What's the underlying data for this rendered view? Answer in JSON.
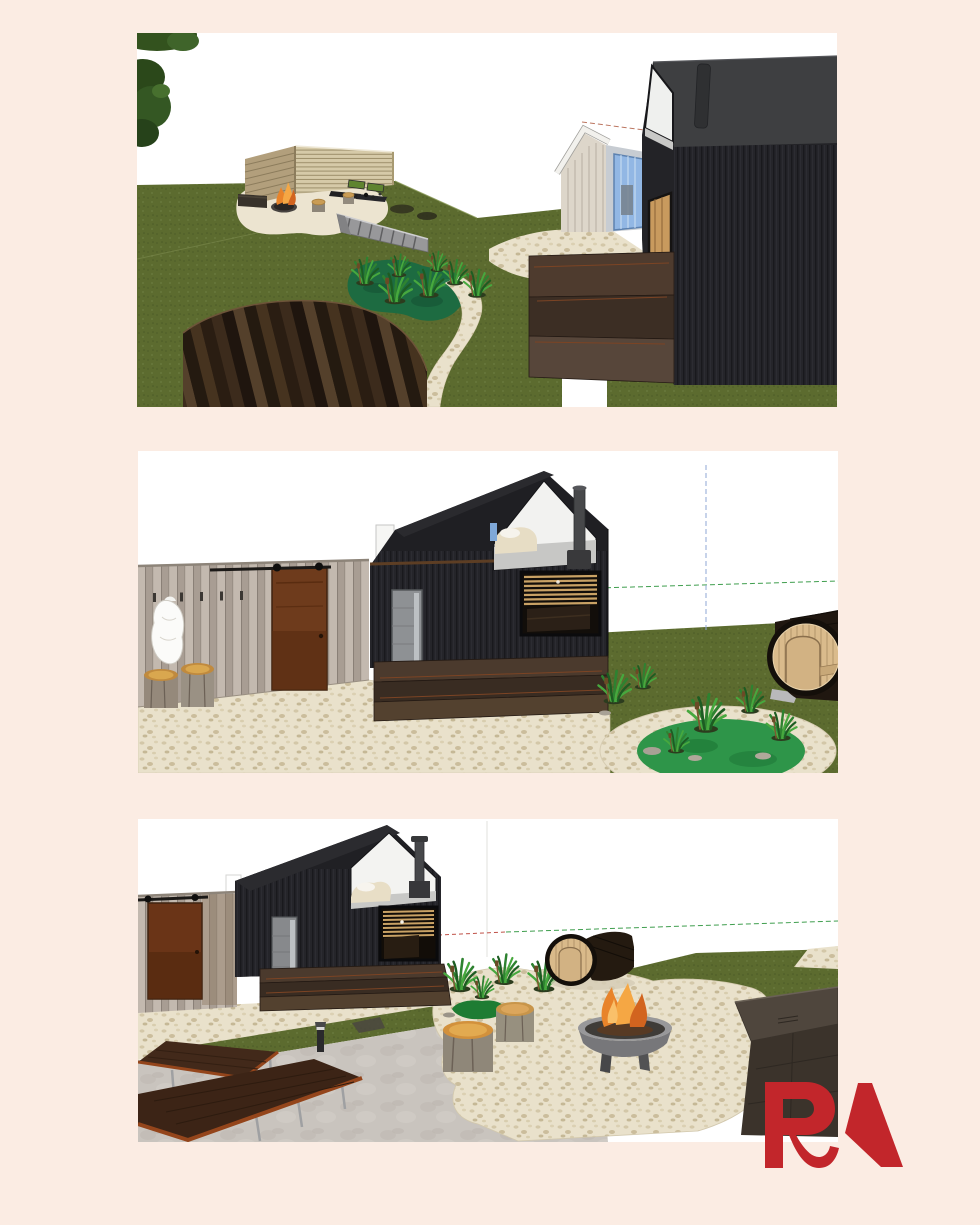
{
  "page": {
    "background_color": "#fbece3",
    "sky_color": "#ffffff"
  },
  "logo": {
    "text": "RA",
    "color": "#c2262b"
  },
  "palette": {
    "grass_green": "#5c6b2f",
    "cabin_black": "#222226",
    "roof_gray": "#3e3f41",
    "pebble_cream": "#e9e1cb",
    "rust_door": "#6e3b1c",
    "wood_tan": "#c9a265",
    "barrel_wood": "#d9ba8a",
    "fire_orange": "#e8832a"
  },
  "renders": [
    {
      "label": "3D garden render: slatted fence lounge with fire pit, stairs, planted pond, barrel sauna and black cabin"
    },
    {
      "label": "3D render: black sauna cabin with gray plank changing wall, barn door, pebble patio, round planted pond and barrel sauna"
    },
    {
      "label": "3D render: black sauna cabin with fire bowl patio, log stools, barrel sauna, long tables and dark storage box"
    }
  ]
}
